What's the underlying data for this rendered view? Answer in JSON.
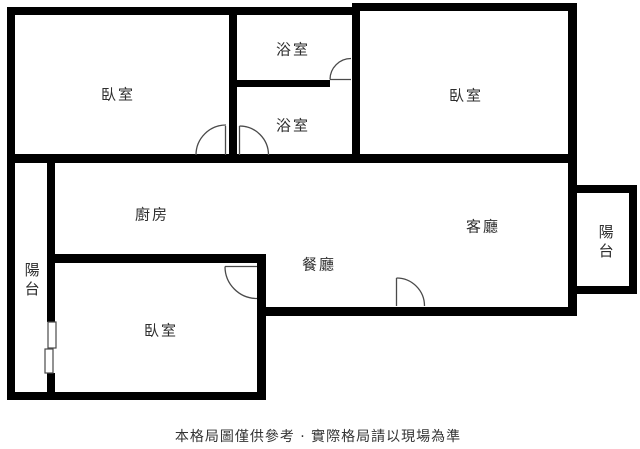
{
  "floorplan": {
    "background_color": "#ffffff",
    "wall_color": "#000000",
    "door_line_color": "#4a4a4a",
    "rooms": [
      {
        "id": "bedroom-top-left",
        "label": "臥室"
      },
      {
        "id": "bathroom-top",
        "label": "浴室"
      },
      {
        "id": "bathroom-middle",
        "label": "浴室"
      },
      {
        "id": "bedroom-top-right",
        "label": "臥室"
      },
      {
        "id": "kitchen",
        "label": "廚房"
      },
      {
        "id": "living-room",
        "label": "客廳"
      },
      {
        "id": "dining-room",
        "label": "餐廳"
      },
      {
        "id": "bedroom-bottom",
        "label": "臥室"
      },
      {
        "id": "balcony-left",
        "label": "陽台"
      },
      {
        "id": "balcony-right",
        "label": "陽台"
      }
    ],
    "symbols": [
      {
        "id": "door-arc-bedroom-top-left"
      },
      {
        "id": "door-arc-bathroom-middle"
      },
      {
        "id": "door-arc-bathroom-top"
      },
      {
        "id": "door-arc-bedroom-bottom"
      },
      {
        "id": "door-arc-living-room-entry"
      },
      {
        "id": "window-balcony-left"
      }
    ],
    "caption": "本格局圖僅供參考 · 實際格局請以現場為準"
  }
}
